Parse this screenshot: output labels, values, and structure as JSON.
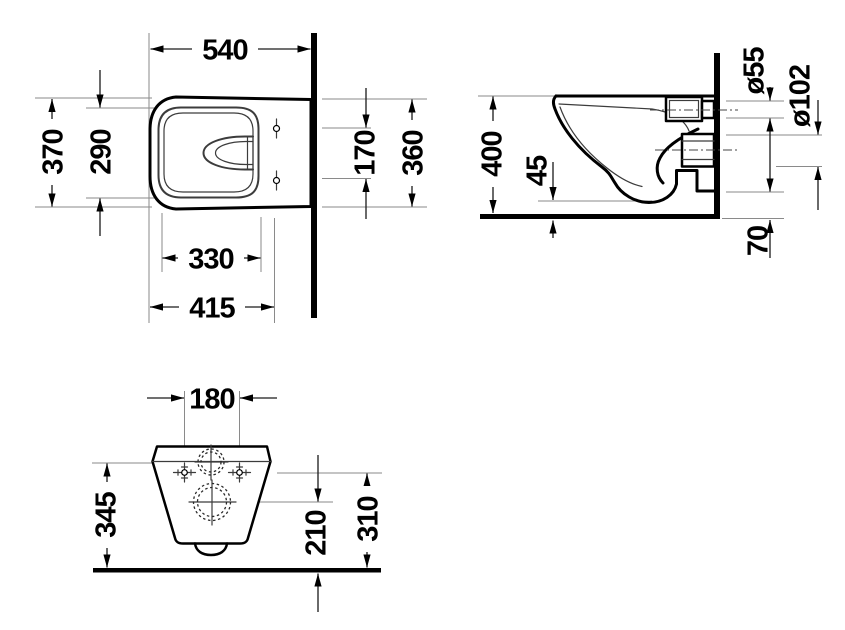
{
  "drawing": {
    "line_color": "#000000",
    "background_color": "#ffffff",
    "views": {
      "plan": {
        "dims": {
          "overall_depth": "540",
          "overall_width": "370",
          "inner_width": "290",
          "seat_hole_spacing": "170",
          "width_at_wall": "360",
          "bowl_inner_length": "330",
          "front_to_seat_holes": "415"
        }
      },
      "side": {
        "dims": {
          "rim_height": "400",
          "bowl_floor_clearance": "45",
          "inlet_diameter": "ø55",
          "outlet_diameter": "ø102",
          "bottom_wall_gap": "70"
        }
      },
      "front": {
        "dims": {
          "fixing_hole_spacing": "180",
          "ceramic_height": "345",
          "outlet_center_height": "210",
          "fixing_hole_height": "310"
        }
      }
    }
  }
}
